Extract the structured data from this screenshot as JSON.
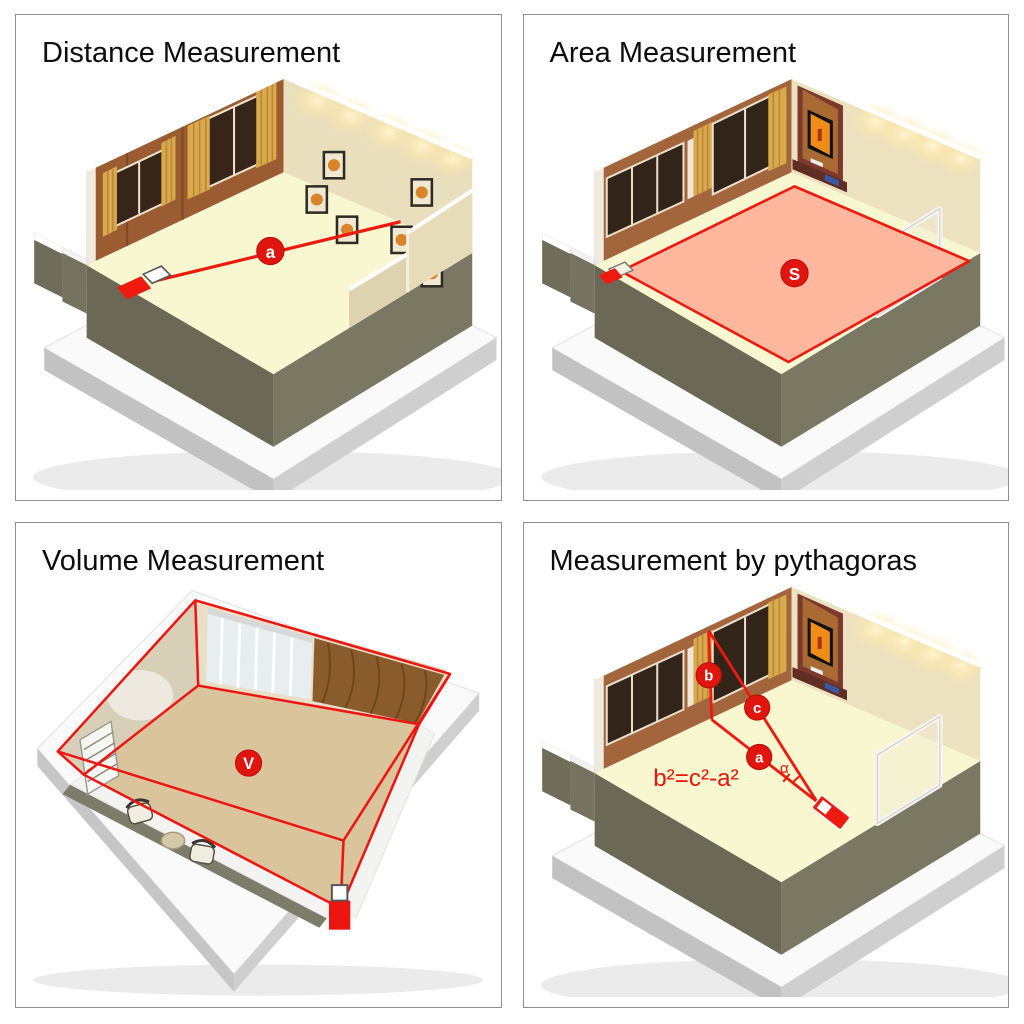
{
  "panels": [
    {
      "id": "distance",
      "title": "Distance Measurement",
      "marker": "a"
    },
    {
      "id": "area",
      "title": "Area Measurement",
      "marker": "S"
    },
    {
      "id": "volume",
      "title": "Volume Measurement",
      "marker": "V"
    },
    {
      "id": "pythagoras",
      "title": "Measurement by pythagoras",
      "marker_a": "a",
      "marker_b": "b",
      "marker_c": "c",
      "angle": "α",
      "formula": "b²=c²-a²"
    }
  ],
  "colors": {
    "laser_red": "#ee1a10",
    "marker_red": "#e0150d",
    "area_fill": "#ffb89d",
    "floor_cream": "#f9f7cf",
    "floor_tan": "#d9c49c",
    "wall_brown": "#9a5c30",
    "wall_cream": "#e9dfbc",
    "podium_olive": "#6b6955",
    "panel_border": "#8f8f8f",
    "title_text": "#0d0d0d"
  },
  "icons": {
    "laser_device": "laser-device-icon"
  }
}
